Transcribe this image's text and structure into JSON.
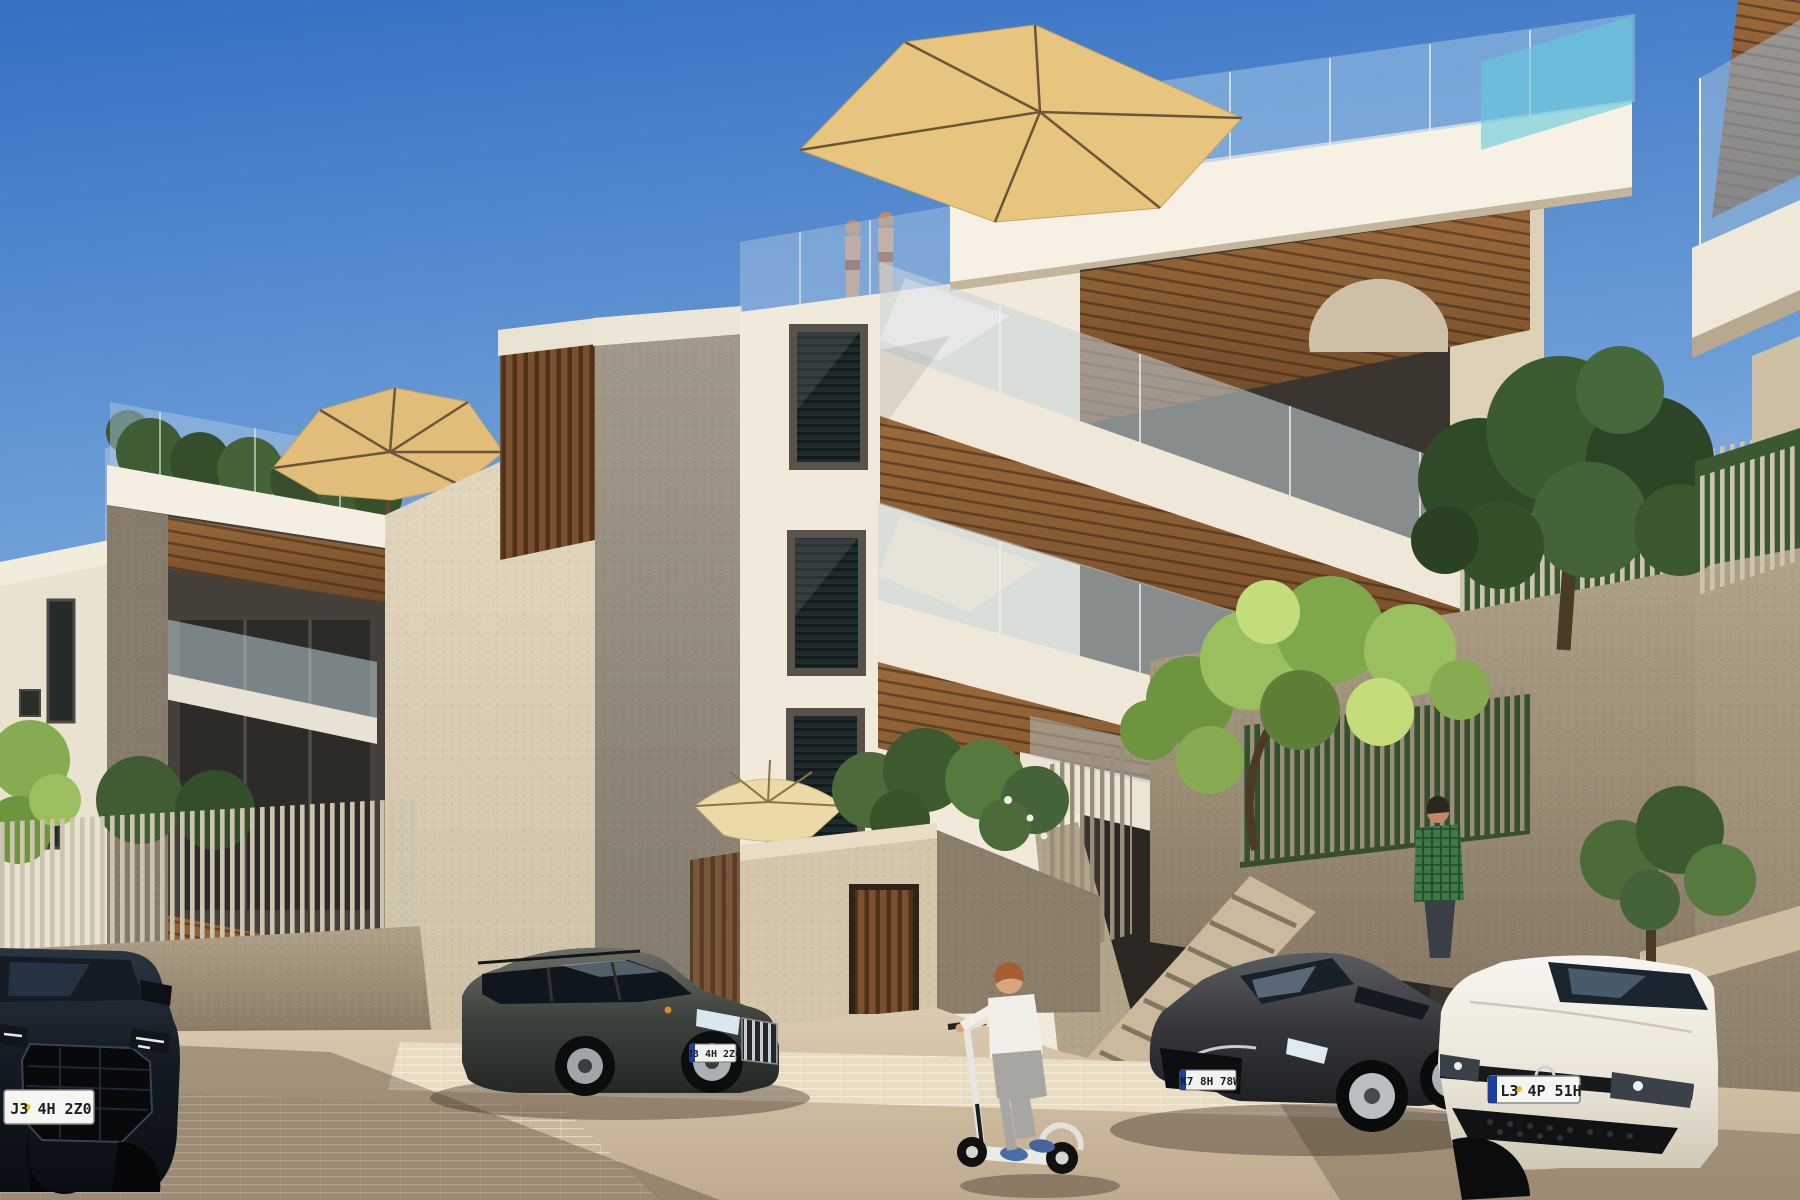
{
  "scene": {
    "kind": "architectural-exterior-render",
    "description": "Sunny 3D rendering of modern terraced apartment buildings with cantilevered balconies, glass railings, rooftop terraces with tan umbrellas, stone retaining walls with slat fences, four parked cars, a boy on a kick scooter and a man in a plaid shirt",
    "time_of_day": "daytime, clear blue sky"
  },
  "buildings": {
    "main": {
      "facade": "white stucco with three dark-framed louvered windows",
      "balconies": "three stacked cantilevered balconies with frameless glass railings, white fascias and timber-slat soffits",
      "rooftop": "roof terrace with glass balustrade, tan cantilever umbrella, planters and two people",
      "extras": [
        "round wicker lounger on top balcony",
        "turquoise glass panel at roof right"
      ]
    },
    "left_block": {
      "rooftop": "green hedge behind glass balustrade with tan patio umbrella",
      "balconies": "recessed balconies with timber soffits and glass balustrades",
      "wall": "large cream stucco side wall"
    },
    "right_neighbor": "balcony corner with glass railing and timber soffit at top right",
    "site": [
      "courtyard wall with vertical-slat timber door",
      "cream garden umbrella and shrubs behind wall",
      "concrete stair with slat balustrade",
      "terraced stone retaining walls with light slat fences",
      "trees and hedges"
    ]
  },
  "vehicles": [
    {
      "id": "suv-front-left",
      "type": "dark SUV, front view, far left",
      "body_color": "#10161c",
      "plate": "J3 4H 2Z0"
    },
    {
      "id": "estate-wagon",
      "type": "dark grey estate wagon, three-quarter front view",
      "body_color": "#3c403c",
      "plate": "J3 4H 2Z0"
    },
    {
      "id": "sedan",
      "type": "dark grey sedan, three-quarter front view",
      "body_color": "#37383a",
      "plate": "K7 8H 78W"
    },
    {
      "id": "white-hatchback",
      "type": "white hatchback, front view, far right",
      "body_color": "#f0eee7",
      "plate": "L3 4P 51H"
    }
  ],
  "people": [
    {
      "id": "boy-on-scooter",
      "description": "boy with ginger hair, white t-shirt, grey trousers, blue shoes riding a white kick scooter"
    },
    {
      "id": "man-plaid-shirt",
      "description": "man in green plaid shirt standing on upper walkway near tree"
    },
    {
      "id": "rooftop-pair",
      "description": "two people in swimwear on the roof terrace behind glass"
    }
  ],
  "props": {
    "umbrellas": [
      "tan cantilever umbrella on main roof terrace",
      "tan patio umbrella on left-block roof",
      "cream garden umbrella behind courtyard wall"
    ]
  },
  "palette": {
    "sky_top": "#3470c2",
    "sky_horizon": "#dfe9f5",
    "facade_white": "#f1eadb",
    "facade_cream": "#d9cdb4",
    "stone_wall": "#a2947c",
    "timber_soffit": "#8a5a33",
    "umbrella_tan": "#e8c57e",
    "glass_tint": "#a8c6e0",
    "pavement": "#d6c5ab",
    "shadow": "#4a3b2e",
    "hedge_green": "#3f5c33",
    "bright_leaf": "#9abf5f"
  }
}
